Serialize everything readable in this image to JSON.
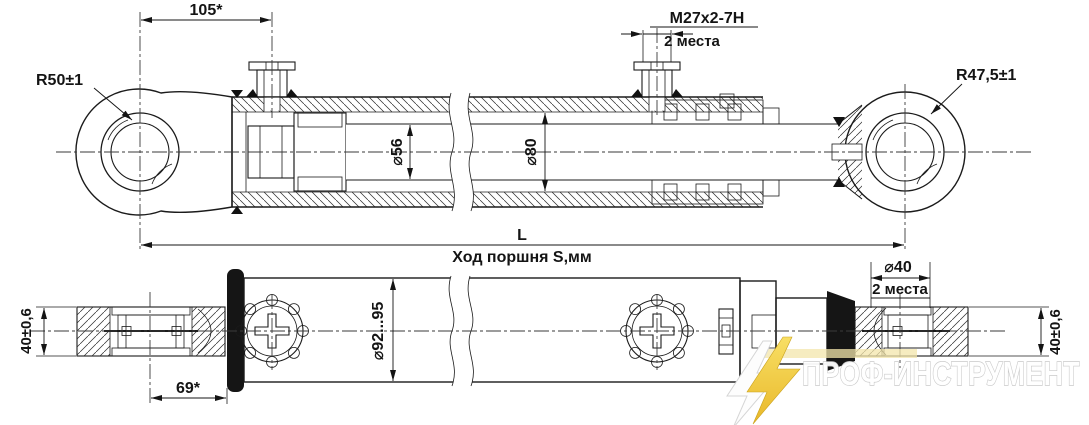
{
  "top_view": {
    "dim_eye_to_port": "105*",
    "thread_spec": "M27x2-7H",
    "thread_places": "2 места",
    "left_eye_radius": "R50±1",
    "right_eye_radius": "R47,5±1",
    "rod_diameter": "⌀56",
    "bore_diameter": "⌀80",
    "length_label": "L",
    "stroke_label": "Ход поршня S,мм"
  },
  "bottom_view": {
    "body_diameter": "⌀92...95",
    "pin_bore_diameter": "⌀40",
    "pin_bore_places": "2 места",
    "left_eye_width": "40±0,6",
    "right_eye_width": "40±0,6",
    "dim_eye_to_body": "69*"
  },
  "watermark": {
    "brand": "ПРОФ-ИНСТРУМЕНТ",
    "accent_color": "#f2c230",
    "outline_color": "#c8c8c8"
  },
  "colors": {
    "line": "#1b1b1b",
    "background": "#ffffff"
  }
}
